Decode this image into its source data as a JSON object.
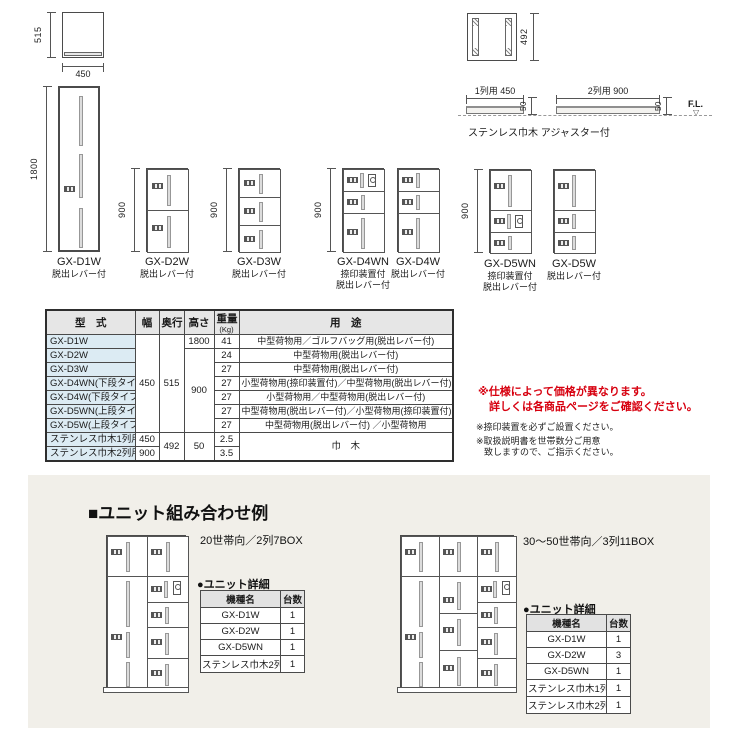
{
  "colors": {
    "accent_red": "#d7000f",
    "panel_bg": "#f1efe9",
    "table_header_bg": "#e6e6e6",
    "model_column_bg": "#dcebf3"
  },
  "top_drawings": {
    "top_view_depth": "515",
    "top_view_width": "450",
    "frame_height": "492",
    "profile1_label": "1列用 450",
    "profile1_height": "50",
    "profile2_label": "2列用 900",
    "profile2_height": "50",
    "fl": "F.L.",
    "fl_mark": "▽",
    "profiles_caption": "ステンレス巾木 アジャスター付"
  },
  "lockers": [
    {
      "model": "GX-D1W",
      "sub1": "脱出レバー付",
      "dim": "1800"
    },
    {
      "model": "GX-D2W",
      "sub1": "脱出レバー付",
      "dim": "900"
    },
    {
      "model": "GX-D3W",
      "sub1": "脱出レバー付",
      "dim": "900"
    },
    {
      "model": "GX-D4WN",
      "sub1": "捺印装置付",
      "sub2": "脱出レバー付",
      "dim": "900"
    },
    {
      "model": "GX-D4W",
      "sub1": "脱出レバー付"
    },
    {
      "model": "GX-D5WN",
      "sub1": "捺印装置付",
      "sub2": "脱出レバー付",
      "dim": "900"
    },
    {
      "model": "GX-D5W",
      "sub1": "脱出レバー付"
    }
  ],
  "spec": {
    "h_model": "型　式",
    "h_width": "幅",
    "h_depth": "奥行",
    "h_height": "高さ",
    "h_weight": "重量",
    "h_weight_unit": "(Kg)",
    "h_use": "用　途",
    "merged": {
      "width": "450",
      "depth": "515",
      "height_mid": "900",
      "depth2": "492",
      "height2": "50",
      "hikimoku_use": "巾　木"
    },
    "rows": [
      {
        "model": "GX-D1W",
        "height": "1800",
        "weight": "41",
        "use": "中型荷物用／ゴルフバッグ用(脱出レバー付)"
      },
      {
        "model": "GX-D2W",
        "weight": "24",
        "use": "中型荷物用(脱出レバー付)"
      },
      {
        "model": "GX-D3W",
        "weight": "27",
        "use": "中型荷物用(脱出レバー付)"
      },
      {
        "model": "GX-D4WN(下段タイプ)",
        "weight": "27",
        "use": "小型荷物用(捺印装置付)／中型荷物用(脱出レバー付)"
      },
      {
        "model": "GX-D4W(下段タイプ)",
        "weight": "27",
        "use": "小型荷物用／中型荷物用(脱出レバー付)"
      },
      {
        "model": "GX-D5WN(上段タイプ)",
        "weight": "27",
        "use": "中型荷物用(脱出レバー付)／小型荷物用(捺印装置付)"
      },
      {
        "model": "GX-D5W(上段タイプ)",
        "weight": "27",
        "use": "中型荷物用(脱出レバー付) ／小型荷物用"
      },
      {
        "model": "ステンレス巾木1列用",
        "width": "450",
        "weight": "2.5"
      },
      {
        "model": "ステンレス巾木2列用",
        "width": "900",
        "weight": "3.5"
      }
    ]
  },
  "notes": {
    "red1": "※仕様によって価格が異なります。",
    "red2": "詳しくは各商品ページをご確認ください。",
    "black1": "※捺印装置を必ずご設置ください。",
    "black2": "※取扱説明書を世帯数分ご用意",
    "black3": "致しますので、ご指示ください。"
  },
  "combo": {
    "section_title": "■ユニット組み合わせ例",
    "left": {
      "title": "20世帯向／2列7BOX",
      "detail_label": "●ユニット詳細",
      "h_model": "機種名",
      "h_qty": "台数",
      "rows": [
        [
          "GX-D1W",
          "1"
        ],
        [
          "GX-D2W",
          "1"
        ],
        [
          "GX-D5WN",
          "1"
        ],
        [
          "ステンレス巾木2列用",
          "1"
        ]
      ]
    },
    "right": {
      "title": "30～50世帯向／3列11BOX",
      "detail_label": "●ユニット詳細",
      "h_model": "機種名",
      "h_qty": "台数",
      "rows": [
        [
          "GX-D1W",
          "1"
        ],
        [
          "GX-D2W",
          "3"
        ],
        [
          "GX-D5WN",
          "1"
        ],
        [
          "ステンレス巾木1列用",
          "1"
        ],
        [
          "ステンレス巾木2列用",
          "1"
        ]
      ]
    }
  }
}
